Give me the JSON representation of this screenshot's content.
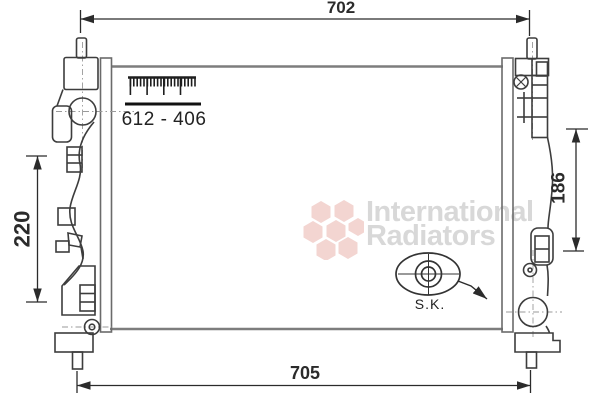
{
  "diagram": {
    "type": "radiator technical drawing",
    "part_number": "612 - 406",
    "dimensions": {
      "top_width": "702",
      "bottom_width": "705",
      "left_height": "220",
      "right_height": "186"
    },
    "detail_label": "S.K."
  },
  "watermark": {
    "line1": "International",
    "line2": "Radiators",
    "text_color": "#d8d8d8",
    "logo_color": "#f3d5d1"
  },
  "colors": {
    "outline": "#3d3d3d",
    "core_edge": "#7d7d7d",
    "dimension": "#2b2b2b",
    "background": "#ffffff"
  }
}
